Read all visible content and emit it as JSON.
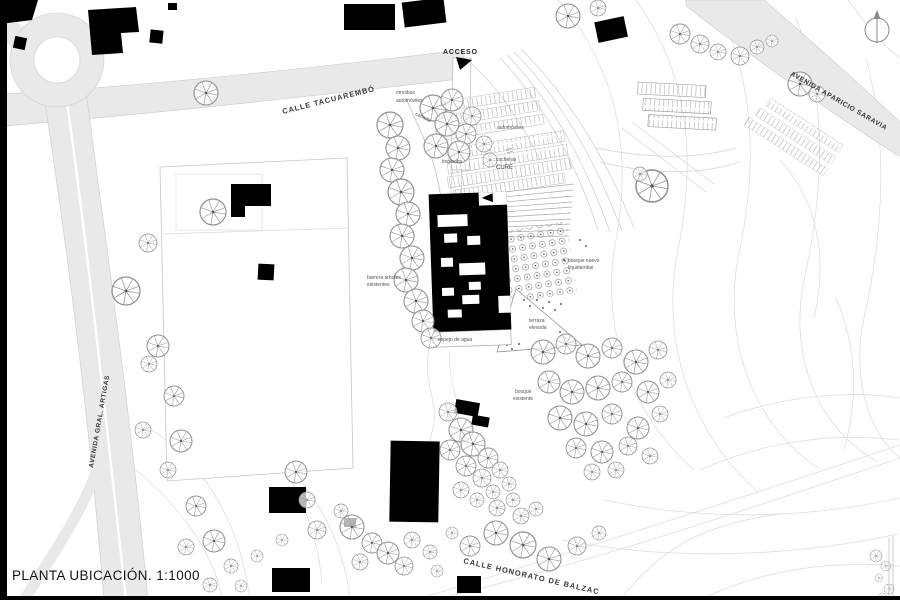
{
  "title": "PLANTA UBICACIÓN. 1:1000",
  "streets": {
    "tacuarembo": "CALLE TACUAREMBÓ",
    "aparicio_saravia": "AVENIDA APARICIO SARAVIA",
    "gral_artigas": "AVENIDA GRAL. ARTIGAS",
    "honorato_balzac": "CALLE HONORATO DE BALZAC",
    "acceso": "ACCESO"
  },
  "annotations": {
    "omnibus": "ómnibus",
    "automoviles_oeste": "automóviles",
    "canada": "cañada",
    "automoviles_este": "automóviles",
    "tinglados": "tinglados",
    "cocheras": "cocheras",
    "cocheras_sigla": "CURE",
    "barrera_arboles_1": "barrera árboles",
    "barrera_arboles_2": "existentes",
    "espejo_de_agua": "espejo de agua",
    "bosque_nuevo_1": "bosque nuevo",
    "bosque_nuevo_2": "liquidambar",
    "terraza_1": "terraza",
    "terraza_2": "elevada",
    "bosque_existente_1": "bosque",
    "bosque_existente_2": "existente"
  },
  "compass": {
    "icon": "north-arrow"
  },
  "colors": {
    "road_fill": "#e9e9e9",
    "road_edge": "#cfcfcf",
    "building_fill": "#000000",
    "contour_line": "#dedede",
    "tree_stroke": "#8f8f8f",
    "annotation_text": "#555555",
    "street_text": "#383838"
  }
}
